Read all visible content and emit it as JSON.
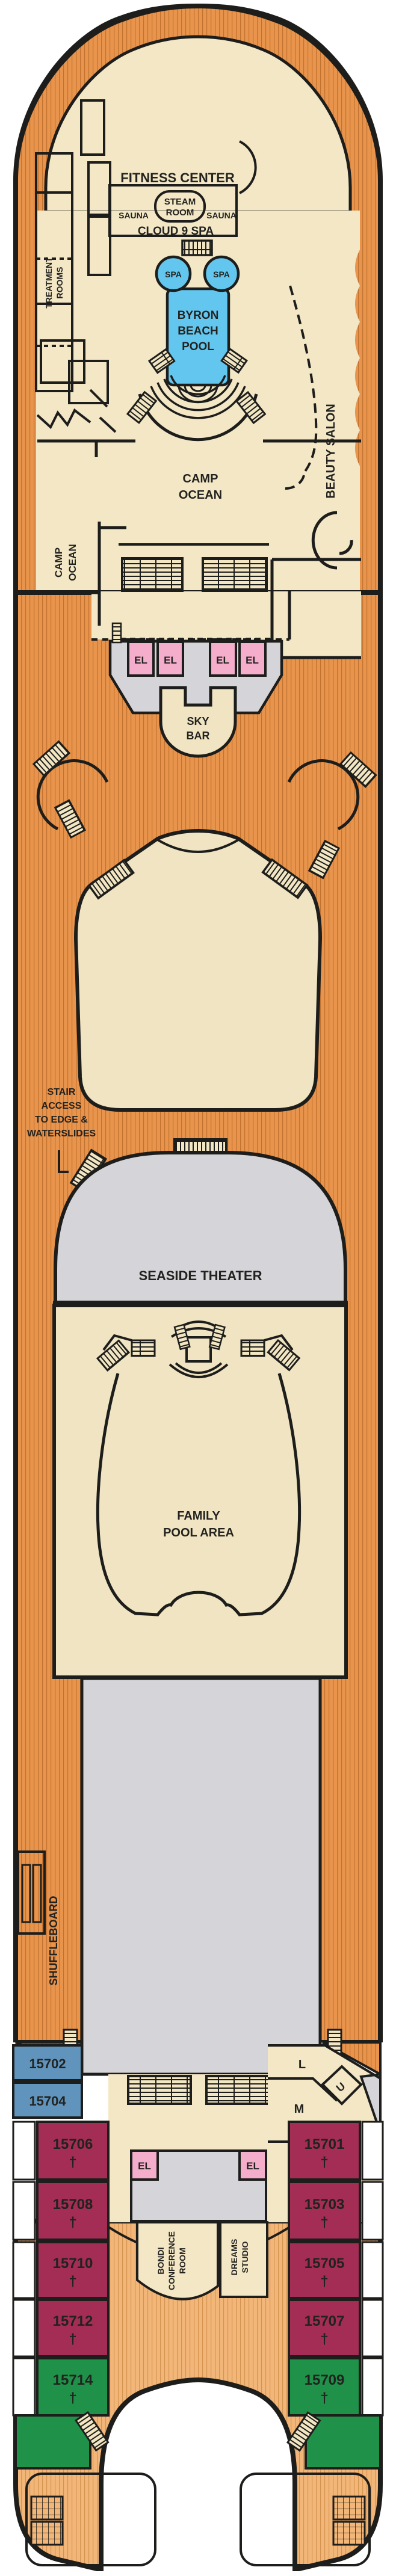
{
  "plan": {
    "type": "cruise-ship-deck-plan",
    "colors": {
      "outline": "#1d1d1b",
      "deck_wood": "#E8944C",
      "deck_wood_stripe": "#C1722F",
      "stern_wood": "#F2B678",
      "stern_wood_stripe": "#D3924D",
      "interior_cream": "#F3E7C6",
      "pool_blue": "#62C6EE",
      "open_gray": "#D5D4D8",
      "elevator_pink": "#F4ADCB",
      "cabin_blue": "#6094BC",
      "cabin_maroon": "#A32D55",
      "cabin_green": "#1F9148",
      "balcony_white": "#FFFFFF"
    }
  },
  "labels": {
    "fitness_center": "FITNESS CENTER",
    "steam_room": [
      "STEAM",
      "ROOM"
    ],
    "sauna_left": "SAUNA",
    "sauna_right": "SAUNA",
    "cloud9_spa": "CLOUD 9 SPA",
    "treatment_rooms": [
      "TREATMENT",
      "ROOMS"
    ],
    "spa_tub_left": "SPA",
    "spa_tub_right": "SPA",
    "byron_pool": [
      "BYRON",
      "BEACH",
      "POOL"
    ],
    "beauty_salon": "BEAUTY SALON",
    "camp_ocean_main": [
      "CAMP",
      "OCEAN"
    ],
    "camp_ocean_side": [
      "CAMP",
      "OCEAN"
    ],
    "elevator": "EL",
    "sky_bar": [
      "SKY",
      "BAR"
    ],
    "stair_access": [
      "STAIR",
      "ACCESS",
      "TO EDGE &",
      "WATERSLIDES"
    ],
    "seaside_theater": "SEASIDE THEATER",
    "family_pool": [
      "FAMILY",
      "POOL AREA"
    ],
    "shuffleboard": "SHUFFLEBOARD",
    "bondi": [
      "BONDI",
      "CONFERENCE",
      "ROOM"
    ],
    "dreams": [
      "DREAMS",
      "STUDIO"
    ],
    "room_l": "L",
    "room_m": "M",
    "room_u": "U"
  },
  "cabins": {
    "blue": [
      {
        "number": "15702"
      },
      {
        "number": "15704"
      }
    ],
    "left": [
      {
        "number": "15706",
        "dagger": "†"
      },
      {
        "number": "15708",
        "dagger": "†"
      },
      {
        "number": "15710",
        "dagger": "†"
      },
      {
        "number": "15712",
        "dagger": "†"
      },
      {
        "number": "15714",
        "dagger": "†"
      }
    ],
    "right": [
      {
        "number": "15701",
        "dagger": "†"
      },
      {
        "number": "15703",
        "dagger": "†"
      },
      {
        "number": "15705",
        "dagger": "†"
      },
      {
        "number": "15707",
        "dagger": "†"
      },
      {
        "number": "15709",
        "dagger": "†"
      }
    ]
  }
}
